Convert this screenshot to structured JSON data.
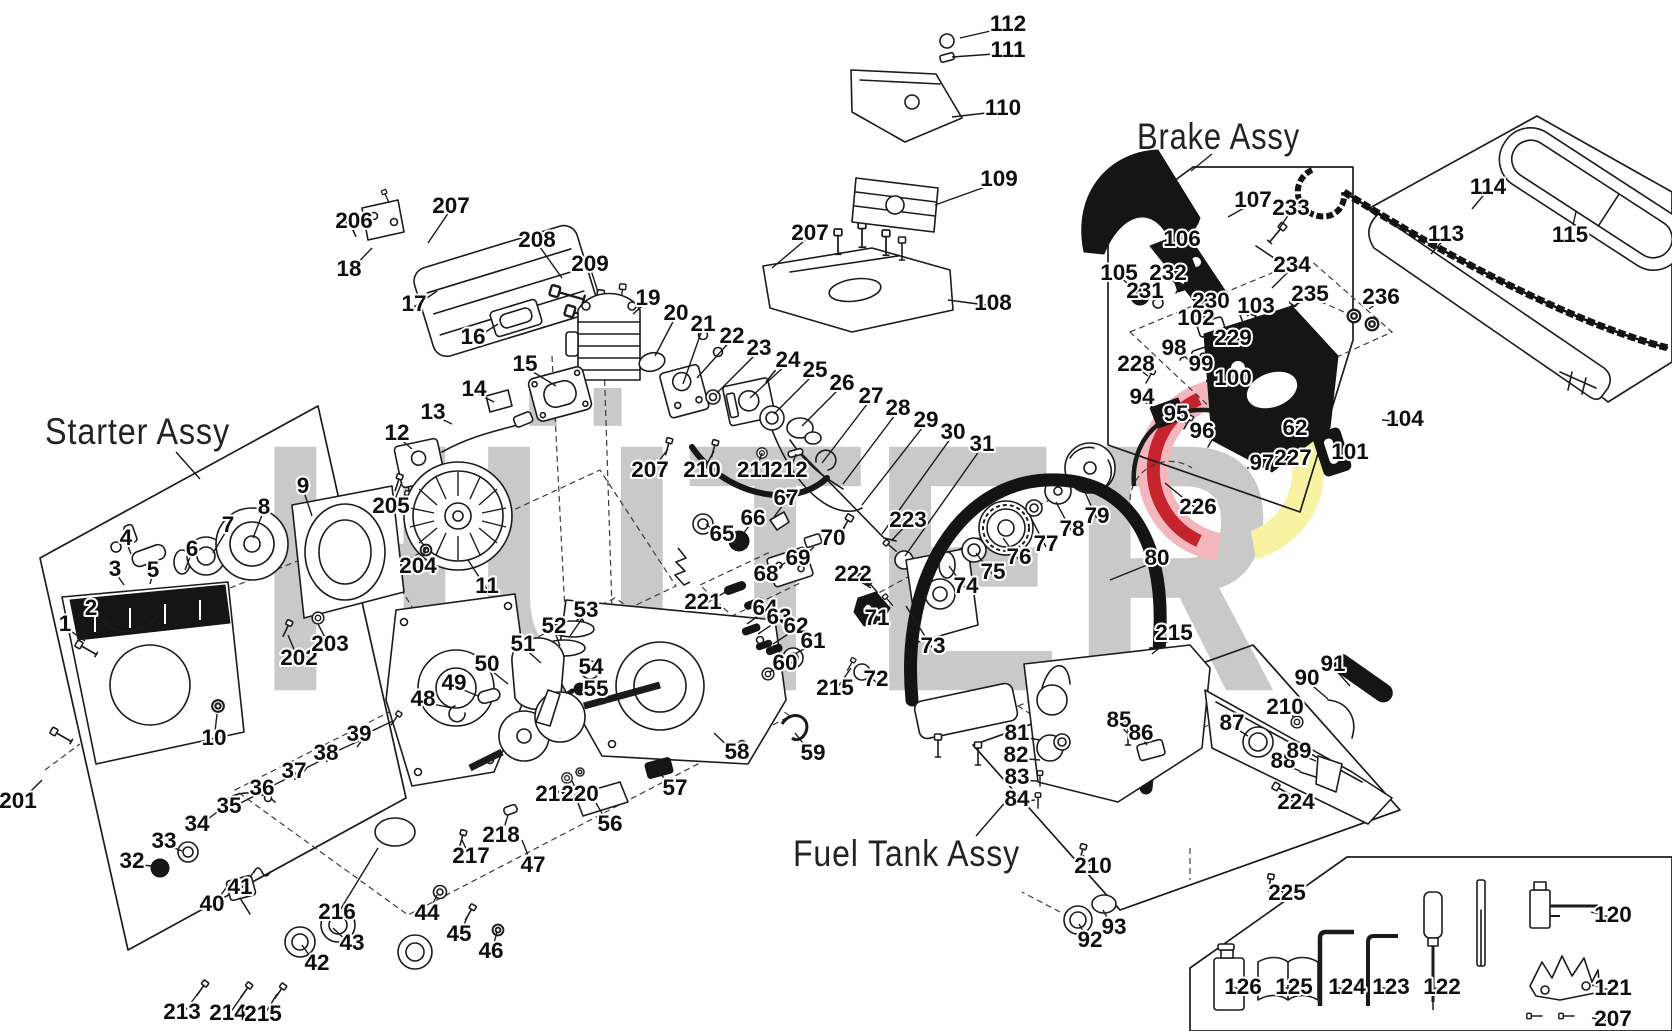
{
  "labels": {
    "starter": "Starter Assy",
    "brake": "Brake Assy",
    "fuel": "Fuel Tank Assy"
  },
  "watermark": {
    "text": "HÜTER",
    "gray": "#c9c9c9",
    "emblem_pink": "#f2b6bc",
    "emblem_red": "#c5242c",
    "emblem_yellow": "#f8f2a3"
  },
  "callouts": [
    {
      "n": "112",
      "x": 1008,
      "y": 23,
      "tx": 960,
      "ty": 38
    },
    {
      "n": "111",
      "x": 1008,
      "y": 49,
      "tx": 952,
      "ty": 57
    },
    {
      "n": "110",
      "x": 1003,
      "y": 107,
      "tx": 952,
      "ty": 117
    },
    {
      "n": "109",
      "x": 999,
      "y": 178,
      "tx": 935,
      "ty": 205
    },
    {
      "n": "108",
      "x": 993,
      "y": 302,
      "tx": 948,
      "ty": 300
    },
    {
      "n": "207",
      "x": 810,
      "y": 232,
      "tx": 772,
      "ty": 268
    },
    {
      "n": "206",
      "x": 354,
      "y": 220,
      "tx": 372,
      "ty": 226
    },
    {
      "n": "207",
      "x": 451,
      "y": 205,
      "tx": 428,
      "ty": 243
    },
    {
      "n": "18",
      "x": 349,
      "y": 268,
      "tx": 372,
      "ty": 248
    },
    {
      "n": "17",
      "x": 414,
      "y": 303,
      "tx": 437,
      "ty": 291
    },
    {
      "n": "16",
      "x": 473,
      "y": 336,
      "tx": 498,
      "ty": 324
    },
    {
      "n": "208",
      "x": 537,
      "y": 239,
      "tx": 562,
      "ty": 278
    },
    {
      "n": "209",
      "x": 590,
      "y": 263,
      "tx": 598,
      "ty": 292
    },
    {
      "n": "19",
      "x": 648,
      "y": 297,
      "tx": 633,
      "ty": 314
    },
    {
      "n": "20",
      "x": 676,
      "y": 312,
      "tx": 655,
      "ty": 356
    },
    {
      "n": "21",
      "x": 703,
      "y": 323,
      "tx": 683,
      "ty": 384
    },
    {
      "n": "15",
      "x": 525,
      "y": 363,
      "tx": 556,
      "ty": 386
    },
    {
      "n": "14",
      "x": 474,
      "y": 388,
      "tx": 494,
      "ty": 402
    },
    {
      "n": "13",
      "x": 433,
      "y": 411,
      "tx": 452,
      "ty": 424
    },
    {
      "n": "12",
      "x": 397,
      "y": 432,
      "tx": 412,
      "ty": 449
    },
    {
      "n": "205",
      "x": 391,
      "y": 505,
      "tx": 402,
      "ty": 482
    },
    {
      "n": "204",
      "x": 418,
      "y": 565,
      "tx": 426,
      "ty": 548
    },
    {
      "n": "11",
      "x": 487,
      "y": 585,
      "tx": 468,
      "ty": 560
    },
    {
      "n": "22",
      "x": 732,
      "y": 335,
      "tx": 697,
      "ty": 378
    },
    {
      "n": "23",
      "x": 759,
      "y": 347,
      "tx": 717,
      "ty": 393
    },
    {
      "n": "24",
      "x": 788,
      "y": 359,
      "tx": 750,
      "ty": 398
    },
    {
      "n": "25",
      "x": 815,
      "y": 369,
      "tx": 774,
      "ty": 414
    },
    {
      "n": "26",
      "x": 842,
      "y": 382,
      "tx": 802,
      "ty": 426
    },
    {
      "n": "27",
      "x": 871,
      "y": 395,
      "tx": 822,
      "ty": 463
    },
    {
      "n": "28",
      "x": 898,
      "y": 407,
      "tx": 843,
      "ty": 484
    },
    {
      "n": "29",
      "x": 926,
      "y": 419,
      "tx": 862,
      "ty": 505
    },
    {
      "n": "30",
      "x": 953,
      "y": 431,
      "tx": 882,
      "ty": 534
    },
    {
      "n": "31",
      "x": 982,
      "y": 443,
      "tx": 905,
      "ty": 556
    },
    {
      "n": "207",
      "x": 650,
      "y": 469,
      "tx": 668,
      "ty": 449
    },
    {
      "n": "210",
      "x": 702,
      "y": 469,
      "tx": 714,
      "ty": 451
    },
    {
      "n": "211",
      "x": 755,
      "y": 469,
      "tx": 762,
      "ty": 453
    },
    {
      "n": "212",
      "x": 789,
      "y": 469,
      "tx": 796,
      "ty": 454
    },
    {
      "n": "65",
      "x": 722,
      "y": 533,
      "tx": 706,
      "ty": 524
    },
    {
      "n": "66",
      "x": 753,
      "y": 517,
      "tx": 739,
      "ty": 539
    },
    {
      "n": "67",
      "x": 786,
      "y": 497,
      "tx": 774,
      "ty": 517
    },
    {
      "n": "68",
      "x": 766,
      "y": 573,
      "tx": 786,
      "ty": 562
    },
    {
      "n": "69",
      "x": 798,
      "y": 557,
      "tx": 814,
      "ty": 547
    },
    {
      "n": "70",
      "x": 833,
      "y": 537,
      "tx": 845,
      "ty": 527
    },
    {
      "n": "221",
      "x": 703,
      "y": 601,
      "tx": 729,
      "ty": 590
    },
    {
      "n": "222",
      "x": 853,
      "y": 573,
      "tx": 871,
      "ty": 588
    },
    {
      "n": "64",
      "x": 765,
      "y": 607,
      "tx": 747,
      "ty": 624
    },
    {
      "n": "63",
      "x": 779,
      "y": 616,
      "tx": 758,
      "ty": 634
    },
    {
      "n": "62",
      "x": 796,
      "y": 625,
      "tx": 773,
      "ty": 644
    },
    {
      "n": "61",
      "x": 813,
      "y": 640,
      "tx": 793,
      "ty": 655
    },
    {
      "n": "60",
      "x": 785,
      "y": 662,
      "tx": 769,
      "ty": 672
    },
    {
      "n": "71",
      "x": 877,
      "y": 617,
      "tx": 862,
      "ty": 611
    },
    {
      "n": "72",
      "x": 876,
      "y": 678,
      "tx": 864,
      "ty": 671
    },
    {
      "n": "73",
      "x": 933,
      "y": 645,
      "tx": 906,
      "ty": 606
    },
    {
      "n": "223",
      "x": 908,
      "y": 519,
      "tx": 892,
      "ty": 540
    },
    {
      "n": "74",
      "x": 966,
      "y": 585,
      "tx": 949,
      "ty": 566
    },
    {
      "n": "75",
      "x": 993,
      "y": 571,
      "tx": 976,
      "ty": 553
    },
    {
      "n": "76",
      "x": 1019,
      "y": 556,
      "tx": 1003,
      "ty": 538
    },
    {
      "n": "77",
      "x": 1046,
      "y": 543,
      "tx": 1030,
      "ty": 516
    },
    {
      "n": "78",
      "x": 1072,
      "y": 528,
      "tx": 1056,
      "ty": 502
    },
    {
      "n": "79",
      "x": 1097,
      "y": 515,
      "tx": 1084,
      "ty": 490
    },
    {
      "n": "80",
      "x": 1157,
      "y": 557,
      "tx": 1110,
      "ty": 580
    },
    {
      "n": "226",
      "x": 1198,
      "y": 506,
      "tx": 1165,
      "ty": 483
    },
    {
      "n": "215",
      "x": 835,
      "y": 687,
      "tx": 851,
      "ty": 668
    },
    {
      "n": "215",
      "x": 1174,
      "y": 632,
      "tx": 1152,
      "ty": 654
    },
    {
      "n": "1",
      "x": 65,
      "y": 623,
      "tx": 85,
      "ty": 641
    },
    {
      "n": "2",
      "x": 91,
      "y": 607,
      "tx": 107,
      "ty": 624
    },
    {
      "n": "3",
      "x": 115,
      "y": 568,
      "tx": 124,
      "ty": 585
    },
    {
      "n": "4",
      "x": 126,
      "y": 537,
      "tx": 131,
      "ty": 554
    },
    {
      "n": "5",
      "x": 153,
      "y": 569,
      "tx": 150,
      "ty": 584
    },
    {
      "n": "6",
      "x": 192,
      "y": 548,
      "tx": 185,
      "ty": 570
    },
    {
      "n": "7",
      "x": 228,
      "y": 524,
      "tx": 213,
      "ty": 553
    },
    {
      "n": "8",
      "x": 264,
      "y": 506,
      "tx": 253,
      "ty": 538
    },
    {
      "n": "9",
      "x": 303,
      "y": 485,
      "tx": 312,
      "ty": 516
    },
    {
      "n": "10",
      "x": 214,
      "y": 737,
      "tx": 217,
      "ty": 714
    },
    {
      "n": "202",
      "x": 299,
      "y": 657,
      "tx": 288,
      "ty": 635
    },
    {
      "n": "203",
      "x": 330,
      "y": 643,
      "tx": 318,
      "ty": 624
    },
    {
      "n": "201",
      "x": 18,
      "y": 800,
      "tx": 42,
      "ty": 780
    },
    {
      "n": "34",
      "x": 197,
      "y": 823,
      "tx": 228,
      "ty": 804
    },
    {
      "n": "35",
      "x": 229,
      "y": 805,
      "tx": 268,
      "ty": 789
    },
    {
      "n": "36",
      "x": 262,
      "y": 787,
      "tx": 296,
      "ty": 774
    },
    {
      "n": "37",
      "x": 294,
      "y": 770,
      "tx": 328,
      "ty": 757
    },
    {
      "n": "38",
      "x": 326,
      "y": 752,
      "tx": 359,
      "ty": 741
    },
    {
      "n": "39",
      "x": 359,
      "y": 733,
      "tx": 393,
      "ty": 721
    },
    {
      "n": "48",
      "x": 423,
      "y": 698,
      "tx": 452,
      "ty": 708
    },
    {
      "n": "49",
      "x": 454,
      "y": 682,
      "tx": 478,
      "ty": 696
    },
    {
      "n": "50",
      "x": 487,
      "y": 663,
      "tx": 508,
      "ty": 684
    },
    {
      "n": "51",
      "x": 523,
      "y": 643,
      "tx": 541,
      "ty": 663
    },
    {
      "n": "52",
      "x": 554,
      "y": 625,
      "tx": 560,
      "ty": 646
    },
    {
      "n": "53",
      "x": 586,
      "y": 609,
      "tx": 570,
      "ty": 636
    },
    {
      "n": "54",
      "x": 591,
      "y": 666,
      "tx": 582,
      "ty": 673
    },
    {
      "n": "55",
      "x": 596,
      "y": 688,
      "tx": 582,
      "ty": 692
    },
    {
      "n": "56",
      "x": 610,
      "y": 823,
      "tx": 596,
      "ty": 803
    },
    {
      "n": "57",
      "x": 675,
      "y": 787,
      "tx": 659,
      "ty": 772
    },
    {
      "n": "58",
      "x": 737,
      "y": 751,
      "tx": 714,
      "ty": 733
    },
    {
      "n": "59",
      "x": 813,
      "y": 752,
      "tx": 795,
      "ty": 733
    },
    {
      "n": "219",
      "x": 554,
      "y": 793,
      "tx": 567,
      "ty": 782
    },
    {
      "n": "220",
      "x": 580,
      "y": 793,
      "tx": 572,
      "ty": 781
    },
    {
      "n": "218",
      "x": 501,
      "y": 834,
      "tx": 508,
      "ty": 815
    },
    {
      "n": "47",
      "x": 533,
      "y": 864,
      "tx": 522,
      "ty": 840
    },
    {
      "n": "217",
      "x": 471,
      "y": 855,
      "tx": 462,
      "ty": 840
    },
    {
      "n": "216",
      "x": 337,
      "y": 911,
      "tx": 378,
      "ty": 848
    },
    {
      "n": "40",
      "x": 212,
      "y": 903,
      "tx": 229,
      "ty": 884
    },
    {
      "n": "41",
      "x": 240,
      "y": 886,
      "tx": 256,
      "ty": 869
    },
    {
      "n": "42",
      "x": 317,
      "y": 962,
      "tx": 302,
      "ty": 945
    },
    {
      "n": "43",
      "x": 352,
      "y": 942,
      "tx": 333,
      "ty": 928
    },
    {
      "n": "44",
      "x": 427,
      "y": 912,
      "tx": 437,
      "ty": 895
    },
    {
      "n": "45",
      "x": 459,
      "y": 933,
      "tx": 468,
      "ty": 915
    },
    {
      "n": "46",
      "x": 491,
      "y": 950,
      "tx": 497,
      "ty": 932
    },
    {
      "n": "213",
      "x": 182,
      "y": 1011,
      "tx": 199,
      "ty": 992
    },
    {
      "n": "214",
      "x": 228,
      "y": 1012,
      "tx": 244,
      "ty": 993
    },
    {
      "n": "215",
      "x": 263,
      "y": 1013,
      "tx": 277,
      "ty": 994
    },
    {
      "n": "32",
      "x": 132,
      "y": 860,
      "tx": 152,
      "ty": 866
    },
    {
      "n": "33",
      "x": 164,
      "y": 840,
      "tx": 182,
      "ty": 851
    },
    {
      "n": "107",
      "x": 1253,
      "y": 199,
      "tx": 1228,
      "ty": 217
    },
    {
      "n": "233",
      "x": 1291,
      "y": 207,
      "tx": 1279,
      "ty": 229
    },
    {
      "n": "106",
      "x": 1182,
      "y": 238,
      "tx": 1192,
      "ty": 258
    },
    {
      "n": "234",
      "x": 1292,
      "y": 264,
      "tx": 1272,
      "ty": 288
    },
    {
      "n": "105",
      "x": 1119,
      "y": 272,
      "tx": 1137,
      "ty": 292
    },
    {
      "n": "232",
      "x": 1168,
      "y": 272,
      "tx": 1179,
      "ty": 287
    },
    {
      "n": "231",
      "x": 1145,
      "y": 290,
      "tx": 1156,
      "ty": 300
    },
    {
      "n": "230",
      "x": 1211,
      "y": 300,
      "tx": 1202,
      "ty": 310
    },
    {
      "n": "102",
      "x": 1196,
      "y": 317,
      "tx": 1206,
      "ty": 326
    },
    {
      "n": "103",
      "x": 1256,
      "y": 305,
      "tx": 1247,
      "ty": 316
    },
    {
      "n": "235",
      "x": 1310,
      "y": 293,
      "tx": 1292,
      "ty": 307
    },
    {
      "n": "229",
      "x": 1233,
      "y": 337,
      "tx": 1224,
      "ty": 347
    },
    {
      "n": "98",
      "x": 1174,
      "y": 347,
      "tx": 1184,
      "ty": 358
    },
    {
      "n": "99",
      "x": 1201,
      "y": 363,
      "tx": 1209,
      "ty": 373
    },
    {
      "n": "100",
      "x": 1233,
      "y": 377,
      "tx": 1239,
      "ty": 388
    },
    {
      "n": "228",
      "x": 1136,
      "y": 363,
      "tx": 1148,
      "ty": 376
    },
    {
      "n": "94",
      "x": 1142,
      "y": 396,
      "tx": 1154,
      "ty": 408
    },
    {
      "n": "95",
      "x": 1176,
      "y": 413,
      "tx": 1186,
      "ty": 423
    },
    {
      "n": "96",
      "x": 1202,
      "y": 430,
      "tx": 1210,
      "ty": 440
    },
    {
      "n": "97",
      "x": 1262,
      "y": 462,
      "tx": 1247,
      "ty": 468
    },
    {
      "n": "227",
      "x": 1293,
      "y": 457,
      "tx": 1278,
      "ty": 463
    },
    {
      "n": "62",
      "x": 1295,
      "y": 427,
      "tx": 1281,
      "ty": 436
    },
    {
      "n": "101",
      "x": 1350,
      "y": 451,
      "tx": 1333,
      "ty": 456
    },
    {
      "n": "104",
      "x": 1405,
      "y": 418,
      "tx": 1382,
      "ty": 420
    },
    {
      "n": "236",
      "x": 1381,
      "y": 296,
      "tx": 1369,
      "ty": 309
    },
    {
      "n": "114",
      "x": 1488,
      "y": 186,
      "tx": 1472,
      "ty": 209
    },
    {
      "n": "113",
      "x": 1446,
      "y": 233,
      "tx": 1431,
      "ty": 254
    },
    {
      "n": "115",
      "x": 1570,
      "y": 234,
      "tx": 1576,
      "ty": 212
    },
    {
      "n": "81",
      "x": 1017,
      "y": 732,
      "tx": 1040,
      "ty": 740
    },
    {
      "n": "82",
      "x": 1016,
      "y": 754,
      "tx": 1040,
      "ty": 760
    },
    {
      "n": "83",
      "x": 1017,
      "y": 776,
      "tx": 1037,
      "ty": 781
    },
    {
      "n": "84",
      "x": 1017,
      "y": 798,
      "tx": 1035,
      "ty": 800
    },
    {
      "n": "85",
      "x": 1119,
      "y": 719,
      "tx": 1127,
      "ty": 733
    },
    {
      "n": "86",
      "x": 1141,
      "y": 732,
      "tx": 1147,
      "ty": 745
    },
    {
      "n": "87",
      "x": 1232,
      "y": 722,
      "tx": 1248,
      "ty": 736
    },
    {
      "n": "210",
      "x": 1285,
      "y": 706,
      "tx": 1294,
      "ty": 717
    },
    {
      "n": "90",
      "x": 1307,
      "y": 677,
      "tx": 1328,
      "ty": 699
    },
    {
      "n": "91",
      "x": 1333,
      "y": 663,
      "tx": 1350,
      "ty": 686
    },
    {
      "n": "88",
      "x": 1283,
      "y": 760,
      "tx": 1300,
      "ty": 771
    },
    {
      "n": "89",
      "x": 1299,
      "y": 750,
      "tx": 1316,
      "ty": 761
    },
    {
      "n": "224",
      "x": 1296,
      "y": 801,
      "tx": 1283,
      "ty": 791
    },
    {
      "n": "225",
      "x": 1287,
      "y": 892,
      "tx": 1273,
      "ty": 883
    },
    {
      "n": "210",
      "x": 1093,
      "y": 865,
      "tx": 1083,
      "ty": 855
    },
    {
      "n": "92",
      "x": 1090,
      "y": 939,
      "tx": 1079,
      "ty": 924
    },
    {
      "n": "93",
      "x": 1114,
      "y": 926,
      "tx": 1103,
      "ty": 910
    },
    {
      "n": "126",
      "x": 1243,
      "y": 986,
      "tx": 1230,
      "ty": 986
    },
    {
      "n": "125",
      "x": 1294,
      "y": 986,
      "tx": 1280,
      "ty": 986
    },
    {
      "n": "124",
      "x": 1347,
      "y": 986,
      "tx": 1333,
      "ty": 986
    },
    {
      "n": "123",
      "x": 1391,
      "y": 986,
      "tx": 1377,
      "ty": 986
    },
    {
      "n": "122",
      "x": 1442,
      "y": 986,
      "tx": 1428,
      "ty": 986
    },
    {
      "n": "120",
      "x": 1613,
      "y": 914,
      "tx": 1591,
      "ty": 912
    },
    {
      "n": "121",
      "x": 1613,
      "y": 987,
      "tx": 1592,
      "ty": 985
    },
    {
      "n": "207",
      "x": 1613,
      "y": 1018,
      "tx": 1592,
      "ty": 1018
    }
  ]
}
